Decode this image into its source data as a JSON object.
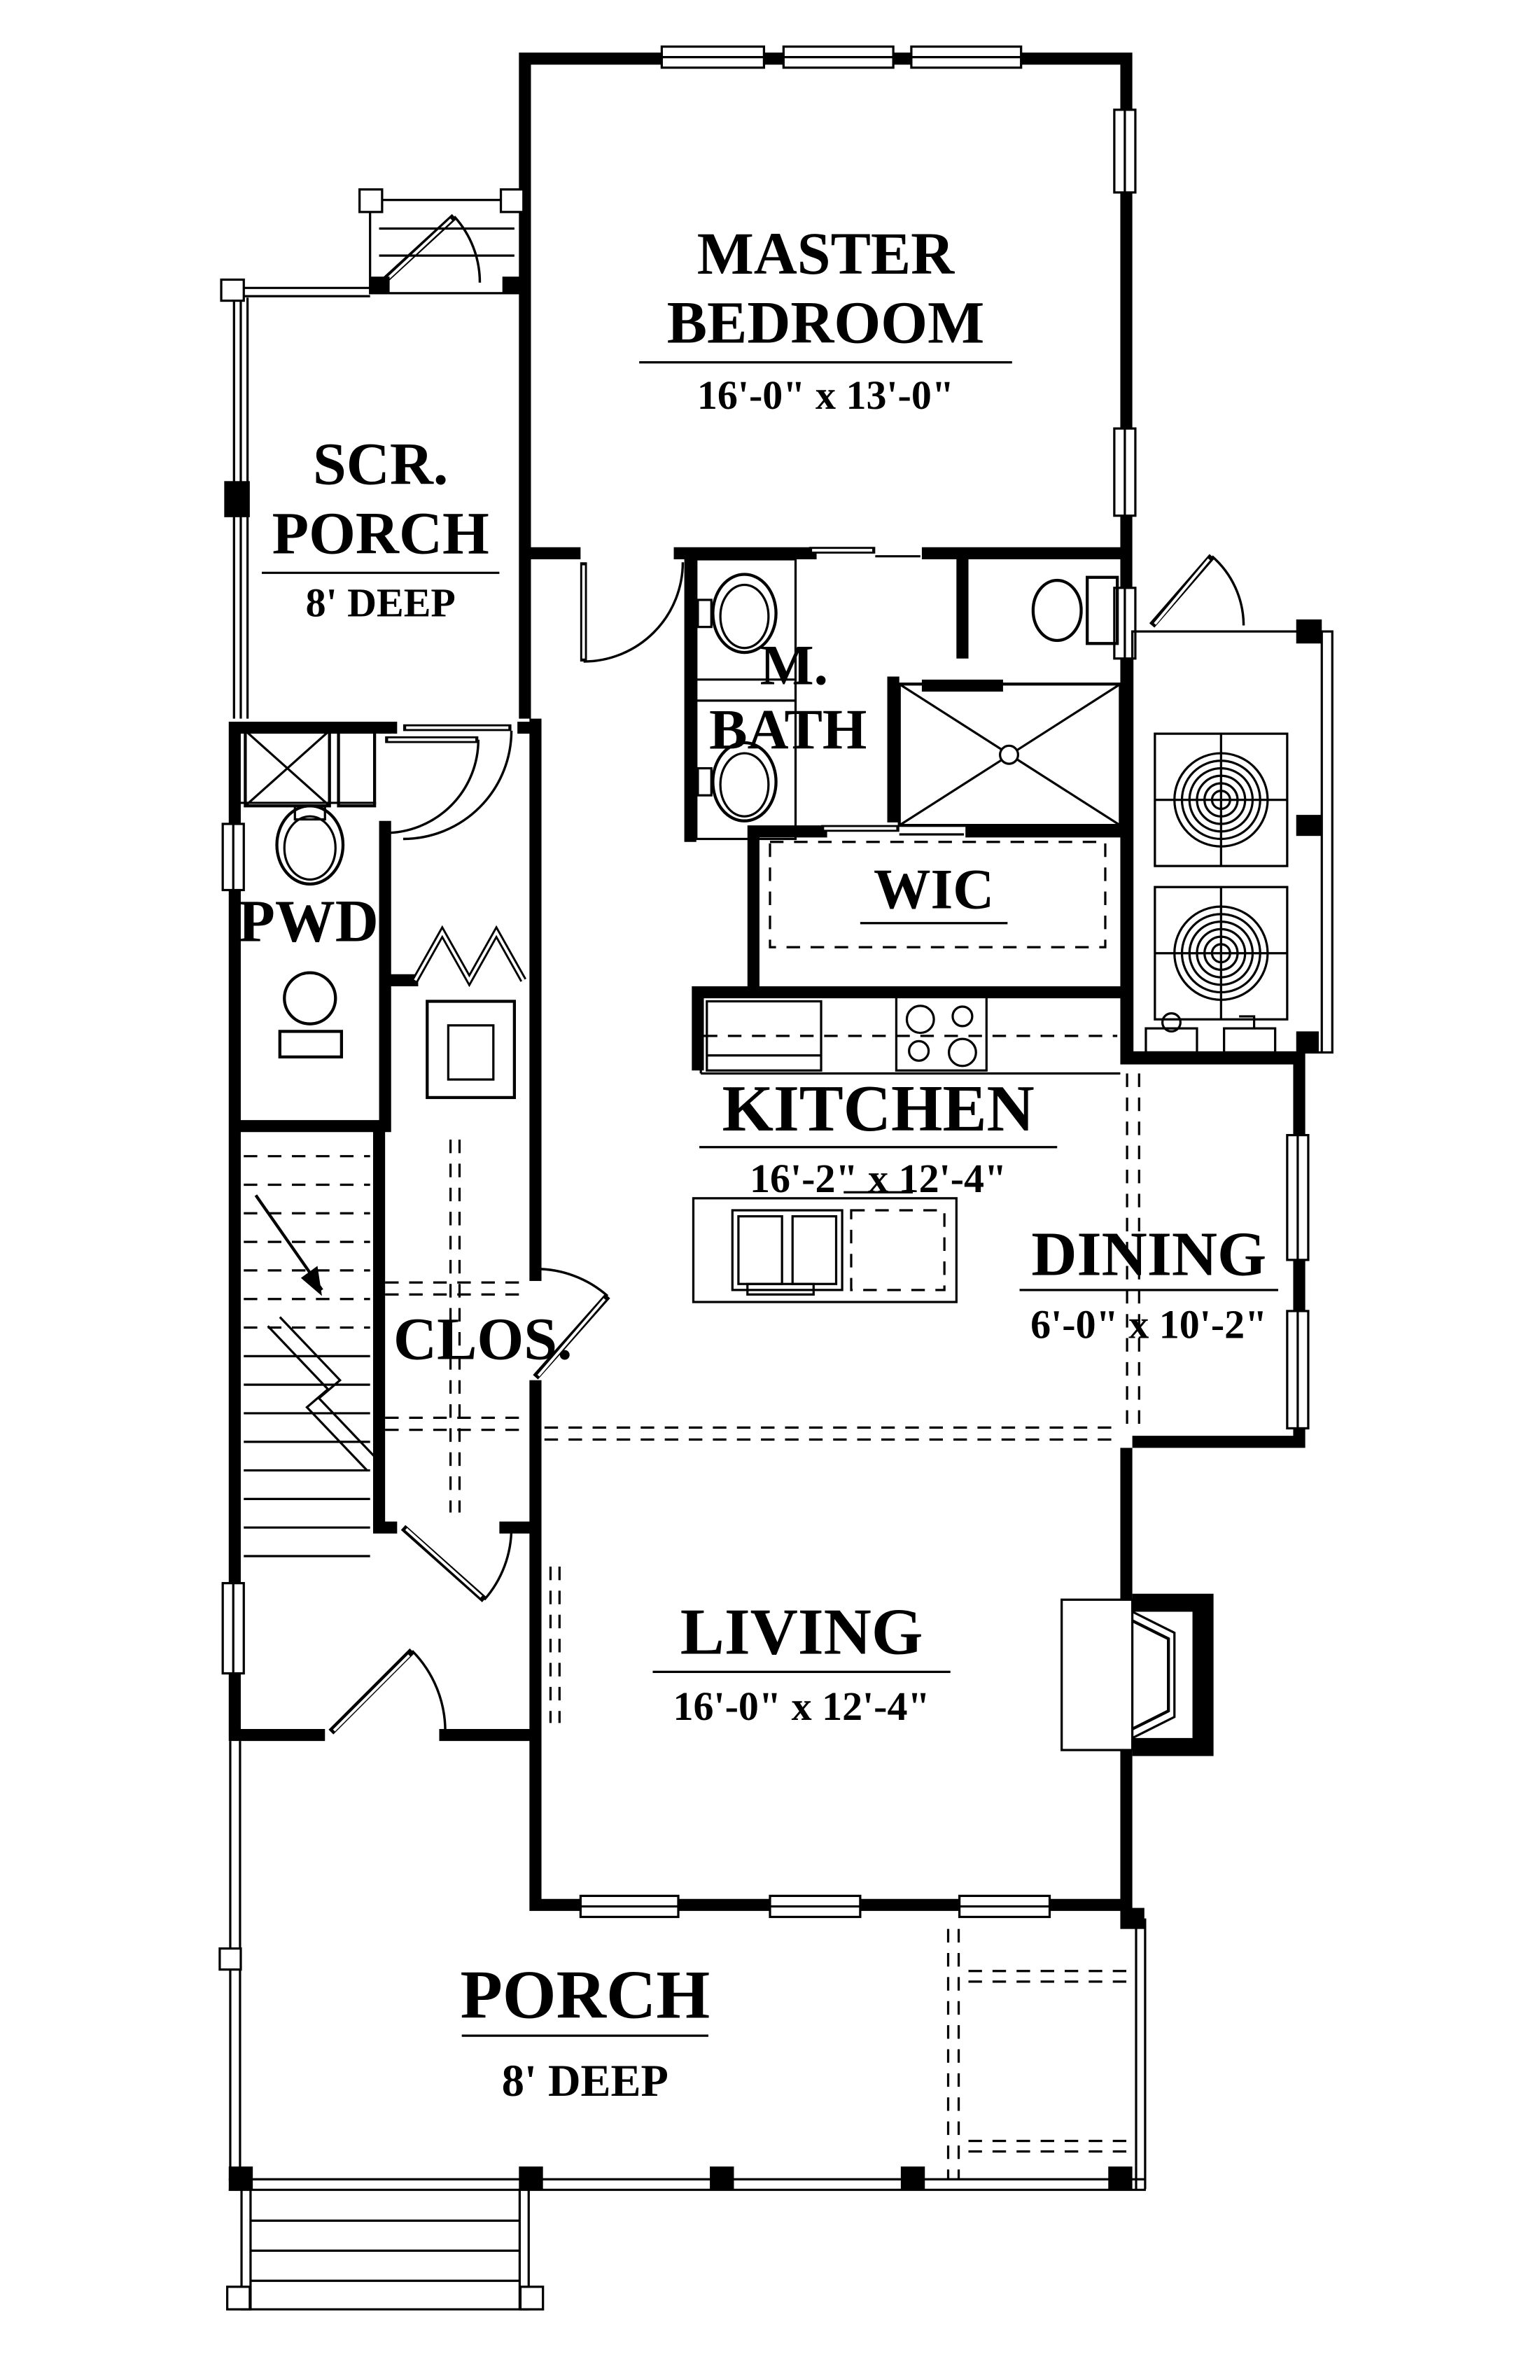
{
  "colors": {
    "line": "#000000",
    "background": "#ffffff"
  },
  "rooms": {
    "master_bedroom": {
      "name_line1": "MASTER",
      "name_line2": "BEDROOM",
      "dimensions": "16'-0\" x 13'-0\""
    },
    "screened_porch": {
      "name_line1": "SCR.",
      "name_line2": "PORCH",
      "dimensions": "8' DEEP"
    },
    "master_bath": {
      "name_line1": "M.",
      "name_line2": "BATH"
    },
    "walk_in_closet": {
      "name": "WIC"
    },
    "powder_room": {
      "name": "PWD"
    },
    "kitchen": {
      "name": "KITCHEN",
      "dimensions": "16'-2\" x 12'-4\""
    },
    "dining": {
      "name": "DINING",
      "dimensions": "6'-0\" x 10'-2\""
    },
    "closet": {
      "name": "CLOS."
    },
    "living": {
      "name": "LIVING",
      "dimensions": "16'-0\" x 12'-4\""
    },
    "front_porch": {
      "name": "PORCH",
      "dimensions": "8' DEEP"
    }
  }
}
